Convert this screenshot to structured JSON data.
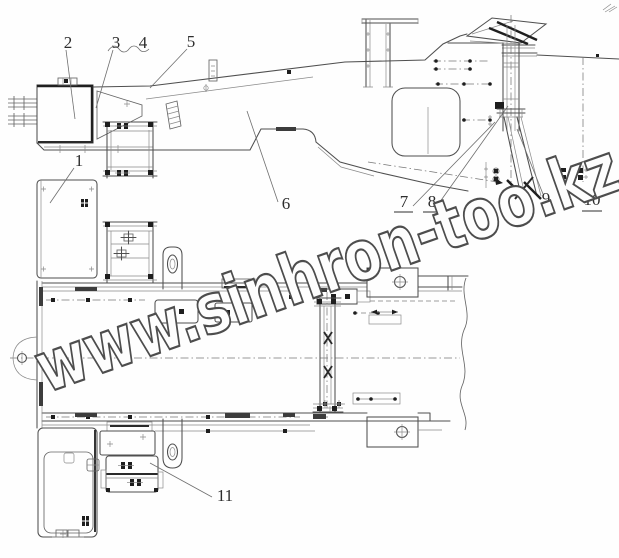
{
  "figure": {
    "type": "technical-line-drawing",
    "views": [
      "side-elevation",
      "plan"
    ],
    "background_color": "#fefefe",
    "line_color": "#4f4f4f",
    "accent_dark": "#1e1e1e"
  },
  "watermark": {
    "text": "www.sinhron-too.kz",
    "outline_color": "#4d4d4d"
  },
  "callouts": [
    {
      "label": "1",
      "underlined": false
    },
    {
      "label": "2",
      "underlined": false
    },
    {
      "label": "3",
      "underlined": false
    },
    {
      "label": "4",
      "underlined": false
    },
    {
      "label": "5",
      "underlined": false
    },
    {
      "label": "6",
      "underlined": false
    },
    {
      "label": "7",
      "underlined": true
    },
    {
      "label": "8",
      "underlined": true
    },
    {
      "label": "9",
      "underlined": false
    },
    {
      "label": "10",
      "underlined": true
    },
    {
      "label": "11",
      "underlined": false
    }
  ]
}
